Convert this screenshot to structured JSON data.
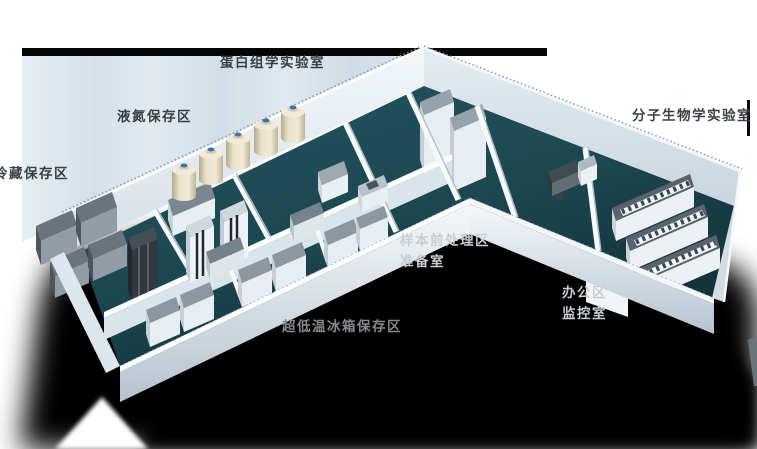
{
  "labels": {
    "proteomics_lab": "蛋白组学实验室",
    "liquid_nitrogen_area": "液氮保存区",
    "cold_storage_area": "冷藏保存区",
    "molecular_biology_lab": "分子生物学实验室",
    "sample_pretreatment_area": "样本前处理区",
    "preparation_room": "准备室",
    "office_area": "办公区",
    "monitoring_room": "监控室",
    "ult_freezer_area": "超低温冰箱保存区"
  },
  "colors": {
    "floor_teal": "#1d4a54",
    "wall_light": "#e9eff4",
    "backdrop_blue": "#d8e3ea",
    "shadow": "#000000",
    "label_dark": "#3a4045",
    "label_light": "#c8cdd2",
    "label_dim": "#85898d",
    "tank_body": "#e8e0c8",
    "tank_cap": "#3a72b0",
    "equipment_gray": "#8a949d"
  }
}
